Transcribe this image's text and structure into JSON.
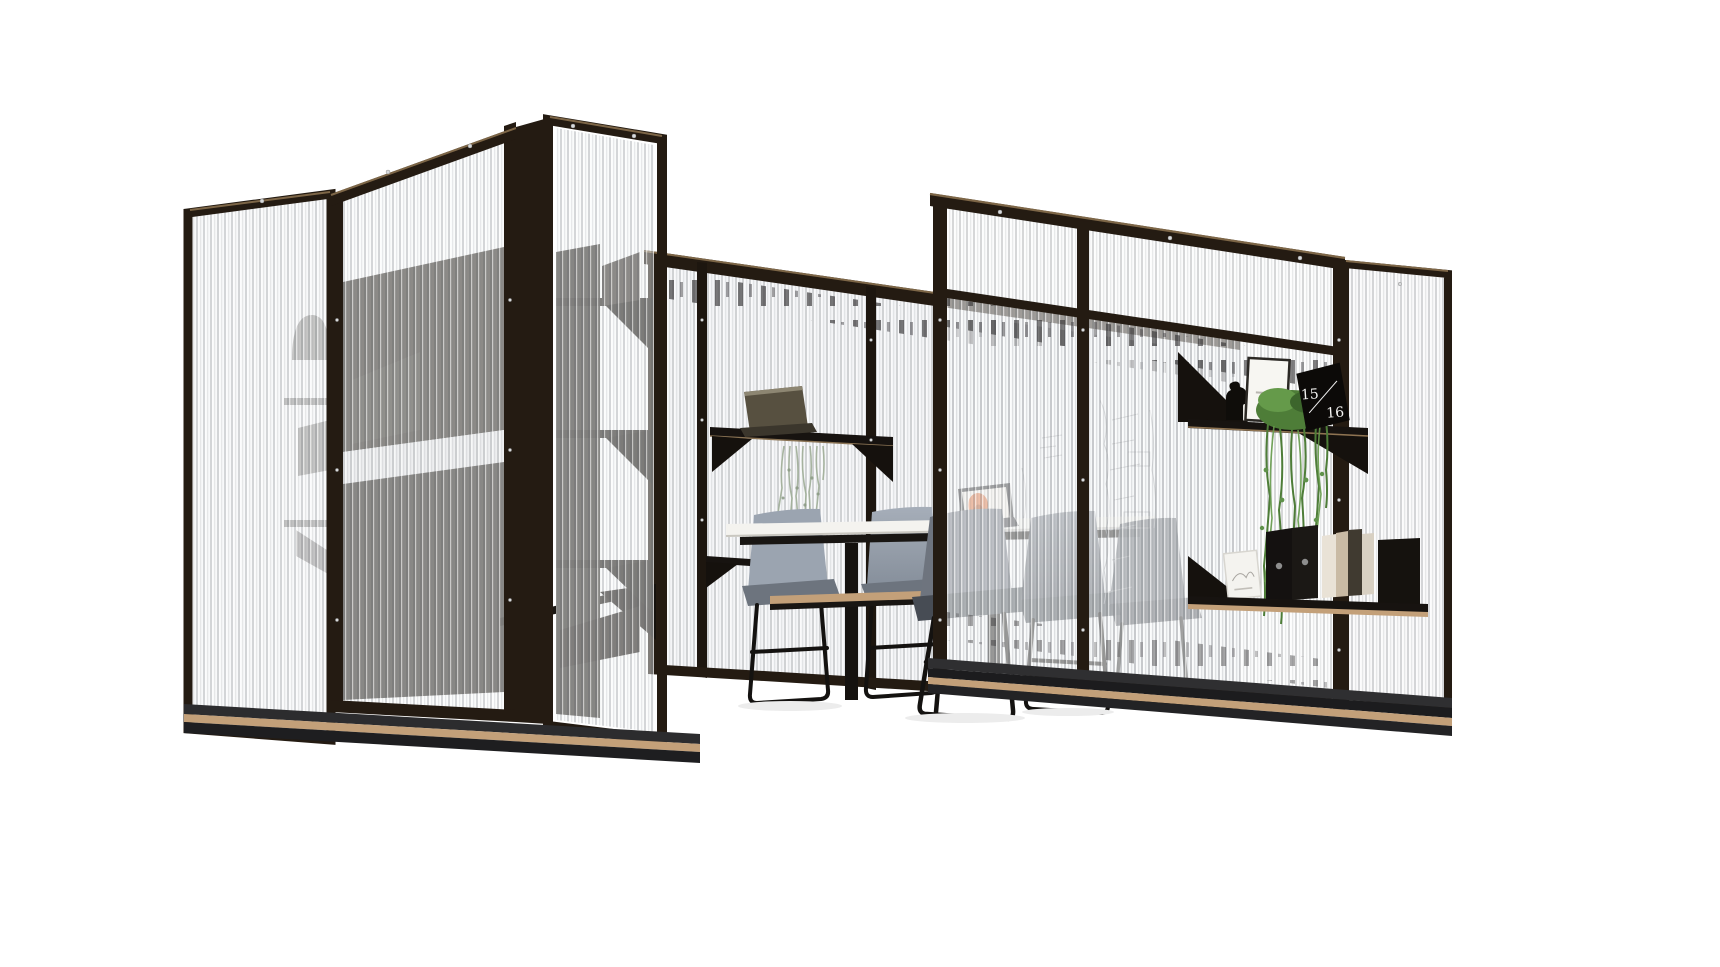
{
  "scene": {
    "description": "3D product render of an open meeting pod built from black-framed fluted glass partition walls, with wall-mounted black shelves, a high white meeting table, grey upholstered bar chairs, laptops and trailing plants",
    "calendar": {
      "top": "15",
      "bottom": "16"
    },
    "colors": {
      "background": "#ffffff",
      "frame": "#241b12",
      "frame_highlight": "#7d6647",
      "glass_stripe": "#585b61",
      "wood_trim": "#c3a079",
      "table_top": "#f4f3ef",
      "chair_light": "#9ba4b0",
      "chair_dark": "#6e747e",
      "cushion_dark": "#474c54",
      "plant_green": "#4e7d38",
      "plant_pale": "#9fae97",
      "laptop_accent": "#e06f38",
      "shelf_black": "#171310",
      "interior_dark": "#37322d",
      "base_dark": "#232325",
      "whiteboard_scribble": "#9a9da2"
    }
  }
}
